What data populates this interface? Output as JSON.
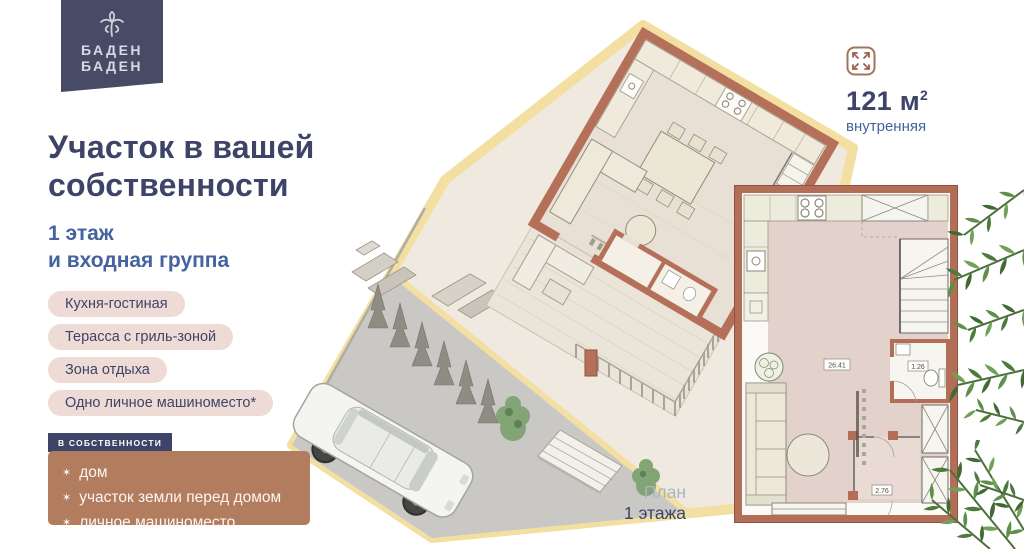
{
  "brand": {
    "line1": "БАДЕН",
    "line2": "БАДЕН"
  },
  "headline": {
    "line1": "Участок в вашей",
    "line2": "собственности"
  },
  "subhead": {
    "line1": "1 этаж",
    "line2": "и входная группа"
  },
  "features": [
    "Кухня-гостиная",
    "Терасса с гриль-зоной",
    "Зона отдыха",
    "Одно личное машиноместо*"
  ],
  "ownership": {
    "tag": "В СОБСТВЕННОСТИ",
    "bullet": "✶",
    "items": [
      "дом",
      "участок земли перед домом",
      "личное машиноместо"
    ]
  },
  "area": {
    "value": "121",
    "unit": "м",
    "sup": "2",
    "caption": "внутренняя"
  },
  "plan_caption": {
    "line1": "План",
    "line2": "1 этажа"
  },
  "floorplan_labels": {
    "living": "26.41",
    "wc": "1.26",
    "hall": "2.76"
  },
  "icons": {
    "logo": "palm-tree-icon",
    "area": "expand-arrows-icon"
  },
  "colors": {
    "navy": "#3d4467",
    "blue": "#44639f",
    "terracotta": "#b36e57",
    "sand": "#f3dfa2",
    "pill_bg": "#eedbd5",
    "ownership_bg": "#b27c5f",
    "plant_green": "#4e7a3d"
  }
}
